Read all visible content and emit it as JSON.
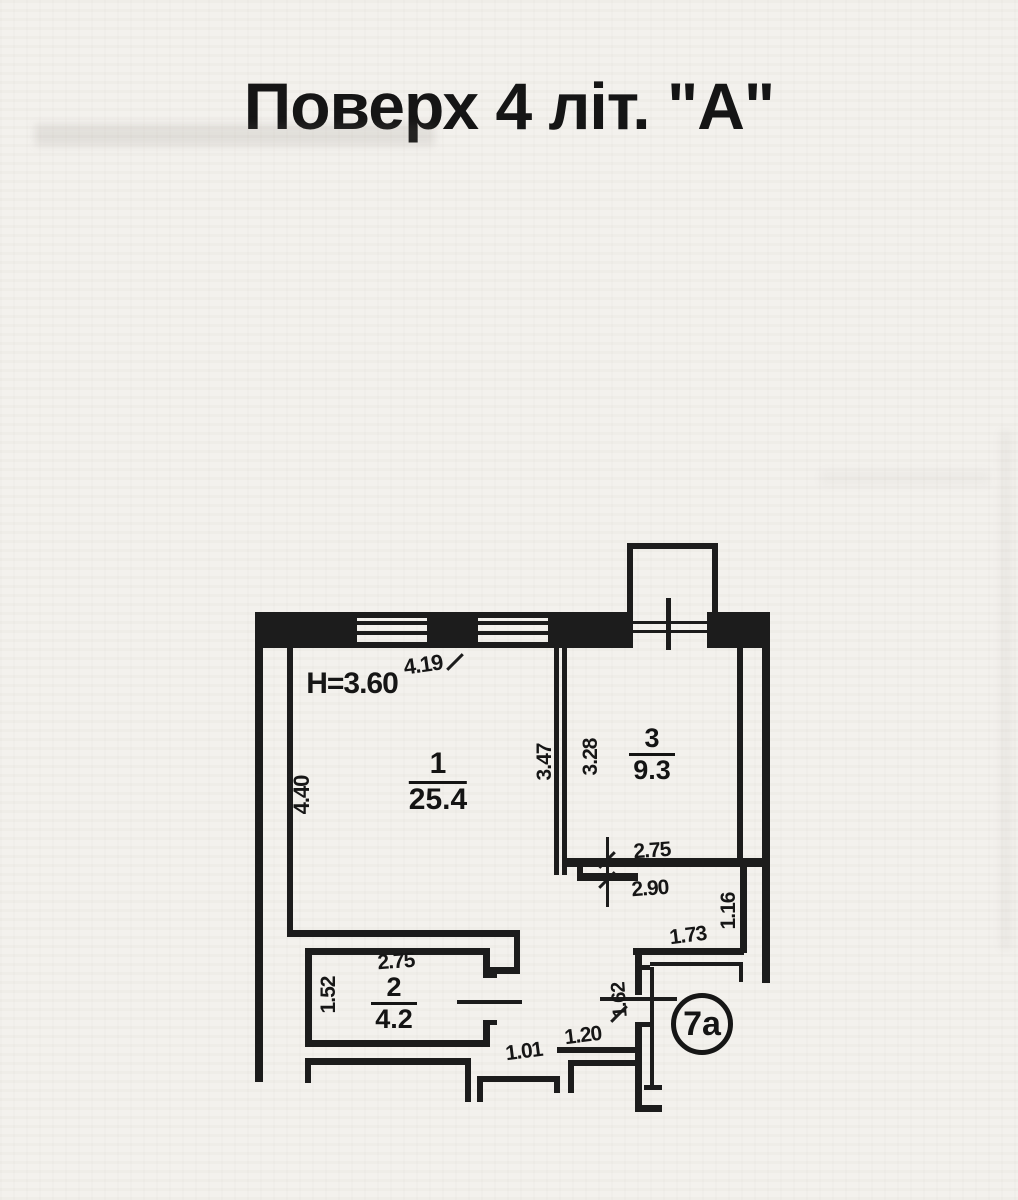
{
  "title": "Поверх 4  літ. \"А\"",
  "plan": {
    "height_note": "H=3.60",
    "rooms": [
      {
        "number": "1",
        "area": "25.4"
      },
      {
        "number": "2",
        "area": "4.2"
      },
      {
        "number": "3",
        "area": "9.3"
      },
      {
        "number": "7а",
        "area": ""
      }
    ],
    "badge": {
      "text": "7а",
      "x": 702,
      "y": 1024,
      "r": 31
    },
    "room_labels": [
      {
        "num": "1",
        "area": "25.4",
        "x": 438,
        "y": 748,
        "size": 30,
        "lw": 42
      },
      {
        "num": "3",
        "area": "9.3",
        "x": 652,
        "y": 724,
        "size": 27,
        "lw": 30
      },
      {
        "num": "2",
        "area": "4.2",
        "x": 394,
        "y": 973,
        "size": 27,
        "lw": 30
      }
    ],
    "dim_labels": [
      {
        "text": "H=3.60",
        "x": 352,
        "y": 684,
        "rot": 0,
        "size": 30
      },
      {
        "text": "4.19",
        "x": 423,
        "y": 665,
        "rot": -8,
        "size": 22
      },
      {
        "text": "4.40",
        "x": 302,
        "y": 795,
        "rot": -90,
        "size": 22
      },
      {
        "text": "3.47",
        "x": 545,
        "y": 762,
        "rot": -90,
        "size": 21
      },
      {
        "text": "3.28",
        "x": 591,
        "y": 757,
        "rot": -90,
        "size": 21
      },
      {
        "text": "2.75",
        "x": 652,
        "y": 851,
        "rot": -4,
        "size": 21
      },
      {
        "text": "2.90",
        "x": 650,
        "y": 889,
        "rot": -4,
        "size": 21
      },
      {
        "text": "1.16",
        "x": 729,
        "y": 911,
        "rot": -90,
        "size": 21
      },
      {
        "text": "1.73",
        "x": 688,
        "y": 936,
        "rot": -7,
        "size": 21
      },
      {
        "text": "2.75",
        "x": 396,
        "y": 962,
        "rot": -4,
        "size": 21
      },
      {
        "text": "1.52",
        "x": 329,
        "y": 995,
        "rot": -90,
        "size": 21
      },
      {
        "text": "1.01",
        "x": 524,
        "y": 1052,
        "rot": -7,
        "size": 21
      },
      {
        "text": "1.20",
        "x": 583,
        "y": 1036,
        "rot": -7,
        "size": 21
      },
      {
        "text": "1.62",
        "x": 620,
        "y": 1000,
        "rot": -94,
        "size": 20
      }
    ],
    "walls": [
      {
        "x": 255,
        "y": 612,
        "w": 102,
        "h": 36
      },
      {
        "x": 427,
        "y": 612,
        "w": 51,
        "h": 36
      },
      {
        "x": 548,
        "y": 612,
        "w": 85,
        "h": 36
      },
      {
        "x": 707,
        "y": 612,
        "w": 63,
        "h": 36
      },
      {
        "x": 255,
        "y": 612,
        "w": 8,
        "h": 470
      },
      {
        "x": 762,
        "y": 612,
        "w": 8,
        "h": 371
      },
      {
        "x": 627,
        "y": 543,
        "w": 6,
        "h": 74
      },
      {
        "x": 627,
        "y": 543,
        "w": 91,
        "h": 6
      },
      {
        "x": 712,
        "y": 543,
        "w": 6,
        "h": 74
      },
      {
        "x": 666,
        "y": 598,
        "w": 5,
        "h": 52
      },
      {
        "x": 287,
        "y": 648,
        "w": 6,
        "h": 289
      },
      {
        "x": 287,
        "y": 930,
        "w": 233,
        "h": 7
      },
      {
        "x": 514,
        "y": 937,
        "w": 6,
        "h": 36
      },
      {
        "x": 490,
        "y": 967,
        "w": 30,
        "h": 7
      },
      {
        "x": 554,
        "y": 648,
        "w": 5,
        "h": 227
      },
      {
        "x": 562,
        "y": 648,
        "w": 5,
        "h": 227
      },
      {
        "x": 737,
        "y": 648,
        "w": 6,
        "h": 210
      },
      {
        "x": 566,
        "y": 858,
        "w": 204,
        "h": 9
      },
      {
        "x": 577,
        "y": 867,
        "w": 6,
        "h": 13
      },
      {
        "x": 577,
        "y": 873,
        "w": 61,
        "h": 8
      },
      {
        "x": 740,
        "y": 867,
        "w": 7,
        "h": 86
      },
      {
        "x": 633,
        "y": 948,
        "w": 111,
        "h": 7
      },
      {
        "x": 635,
        "y": 948,
        "w": 7,
        "h": 47
      },
      {
        "x": 635,
        "y": 1022,
        "w": 7,
        "h": 90
      },
      {
        "x": 635,
        "y": 1105,
        "w": 27,
        "h": 7
      },
      {
        "x": 635,
        "y": 965,
        "w": 15,
        "h": 5
      },
      {
        "x": 635,
        "y": 1022,
        "w": 15,
        "h": 5
      },
      {
        "x": 305,
        "y": 948,
        "w": 185,
        "h": 7
      },
      {
        "x": 305,
        "y": 948,
        "w": 7,
        "h": 99
      },
      {
        "x": 305,
        "y": 1040,
        "w": 185,
        "h": 7
      },
      {
        "x": 483,
        "y": 948,
        "w": 7,
        "h": 30
      },
      {
        "x": 483,
        "y": 1020,
        "w": 7,
        "h": 27
      },
      {
        "x": 483,
        "y": 973,
        "w": 14,
        "h": 5
      },
      {
        "x": 483,
        "y": 1020,
        "w": 14,
        "h": 5
      },
      {
        "x": 557,
        "y": 1047,
        "w": 78,
        "h": 6
      },
      {
        "x": 305,
        "y": 1058,
        "w": 166,
        "h": 7
      },
      {
        "x": 305,
        "y": 1058,
        "w": 6,
        "h": 25
      },
      {
        "x": 465,
        "y": 1058,
        "w": 6,
        "h": 44
      },
      {
        "x": 477,
        "y": 1076,
        "w": 6,
        "h": 26
      },
      {
        "x": 477,
        "y": 1076,
        "w": 83,
        "h": 6
      },
      {
        "x": 554,
        "y": 1076,
        "w": 6,
        "h": 17
      },
      {
        "x": 568,
        "y": 1060,
        "w": 67,
        "h": 6
      },
      {
        "x": 568,
        "y": 1060,
        "w": 6,
        "h": 33
      }
    ],
    "thin_lines": [
      {
        "x": 633,
        "y": 621,
        "w": 74,
        "h": 3
      },
      {
        "x": 633,
        "y": 630,
        "w": 74,
        "h": 3
      },
      {
        "x": 650,
        "y": 962,
        "w": 93,
        "h": 4
      },
      {
        "x": 739,
        "y": 962,
        "w": 4,
        "h": 20
      },
      {
        "x": 650,
        "y": 967,
        "w": 4,
        "h": 120
      },
      {
        "x": 644,
        "y": 1085,
        "w": 18,
        "h": 5
      },
      {
        "x": 600,
        "y": 997,
        "w": 77,
        "h": 4
      },
      {
        "x": 457,
        "y": 1000,
        "w": 65,
        "h": 4
      },
      {
        "x": 606,
        "y": 837,
        "w": 3,
        "h": 70
      }
    ],
    "windows": [
      {
        "x": 357,
        "y": 612,
        "w": 70
      },
      {
        "x": 478,
        "y": 612,
        "w": 70
      }
    ],
    "ticks": [
      {
        "x": 455,
        "y": 662
      },
      {
        "x": 607,
        "y": 860
      },
      {
        "x": 607,
        "y": 880
      },
      {
        "x": 619,
        "y": 1014
      }
    ]
  }
}
